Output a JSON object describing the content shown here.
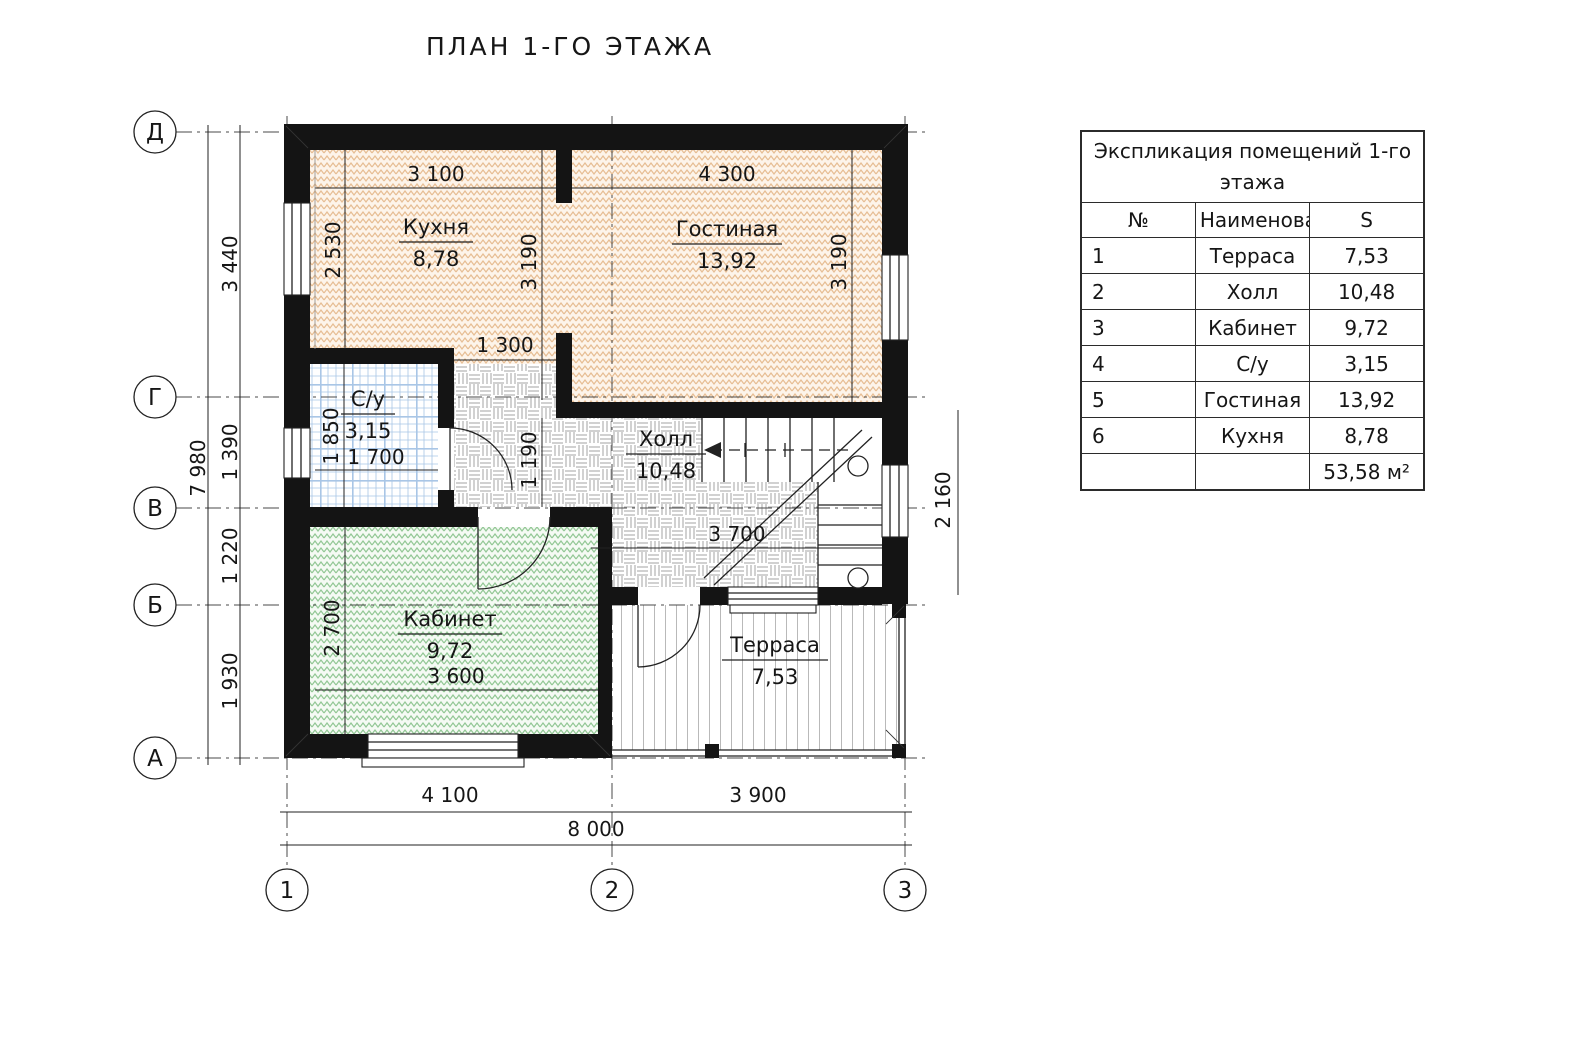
{
  "title": "ПЛАН 1-ГО ЭТАЖА",
  "axes": {
    "row_labels": [
      "Д",
      "Г",
      "В",
      "Б",
      "А"
    ],
    "col_labels": [
      "1",
      "2",
      "3"
    ]
  },
  "outer_dims": {
    "left_total": "7 980",
    "left_segments": [
      "3 440",
      "1 390",
      "1 220",
      "1 930"
    ],
    "bottom_segments": [
      "4 100",
      "3 900"
    ],
    "bottom_total": "8 000"
  },
  "inner_dims": {
    "kitchen_top": "3 100",
    "living_top": "4 300",
    "kitchen_left": "2 530",
    "kitchen_right": "3 190",
    "living_right": "3 190",
    "kitchen_opening": "1 300",
    "bath_left": "1 850",
    "bath_bottom": "1 700",
    "corridor": "1 190",
    "hall_width": "3 700",
    "office_left": "2 700",
    "office_bottom": "3 600",
    "stairs_right": "2 160"
  },
  "rooms": {
    "kitchen": {
      "name": "Кухня",
      "area": "8,78"
    },
    "living": {
      "name": "Гостиная",
      "area": "13,92"
    },
    "bath": {
      "name": "С/у",
      "area": "3,15"
    },
    "hall": {
      "name": "Холл",
      "area": "10,48"
    },
    "office": {
      "name": "Кабинет",
      "area": "9,72"
    },
    "terrace": {
      "name": "Терраса",
      "area": "7,53"
    }
  },
  "legend": {
    "title": "Экспликация помещений  1-го этажа",
    "headers": [
      "№",
      "Наименование",
      "S"
    ],
    "rows": [
      {
        "num": "1",
        "name": "Терраса",
        "area": "7,53"
      },
      {
        "num": "2",
        "name": "Холл",
        "area": "10,48"
      },
      {
        "num": "3",
        "name": "Кабинет",
        "area": "9,72"
      },
      {
        "num": "4",
        "name": "С/у",
        "area": "3,15"
      },
      {
        "num": "5",
        "name": "Гостиная",
        "area": "13,92"
      },
      {
        "num": "6",
        "name": "Кухня",
        "area": "8,78"
      }
    ],
    "total": "53,58 м²"
  },
  "colors": {
    "wall": "#141414",
    "kitchen_bg": "#fdf4ea",
    "kitchen_hatch": "#e6bd93",
    "office_bg": "#f5faf4",
    "office_hatch": "#92c795",
    "bath_grid": "#a9c6e6",
    "hall_hatch": "#a3a3a3",
    "terrace_stripe": "#b9b9b9"
  }
}
